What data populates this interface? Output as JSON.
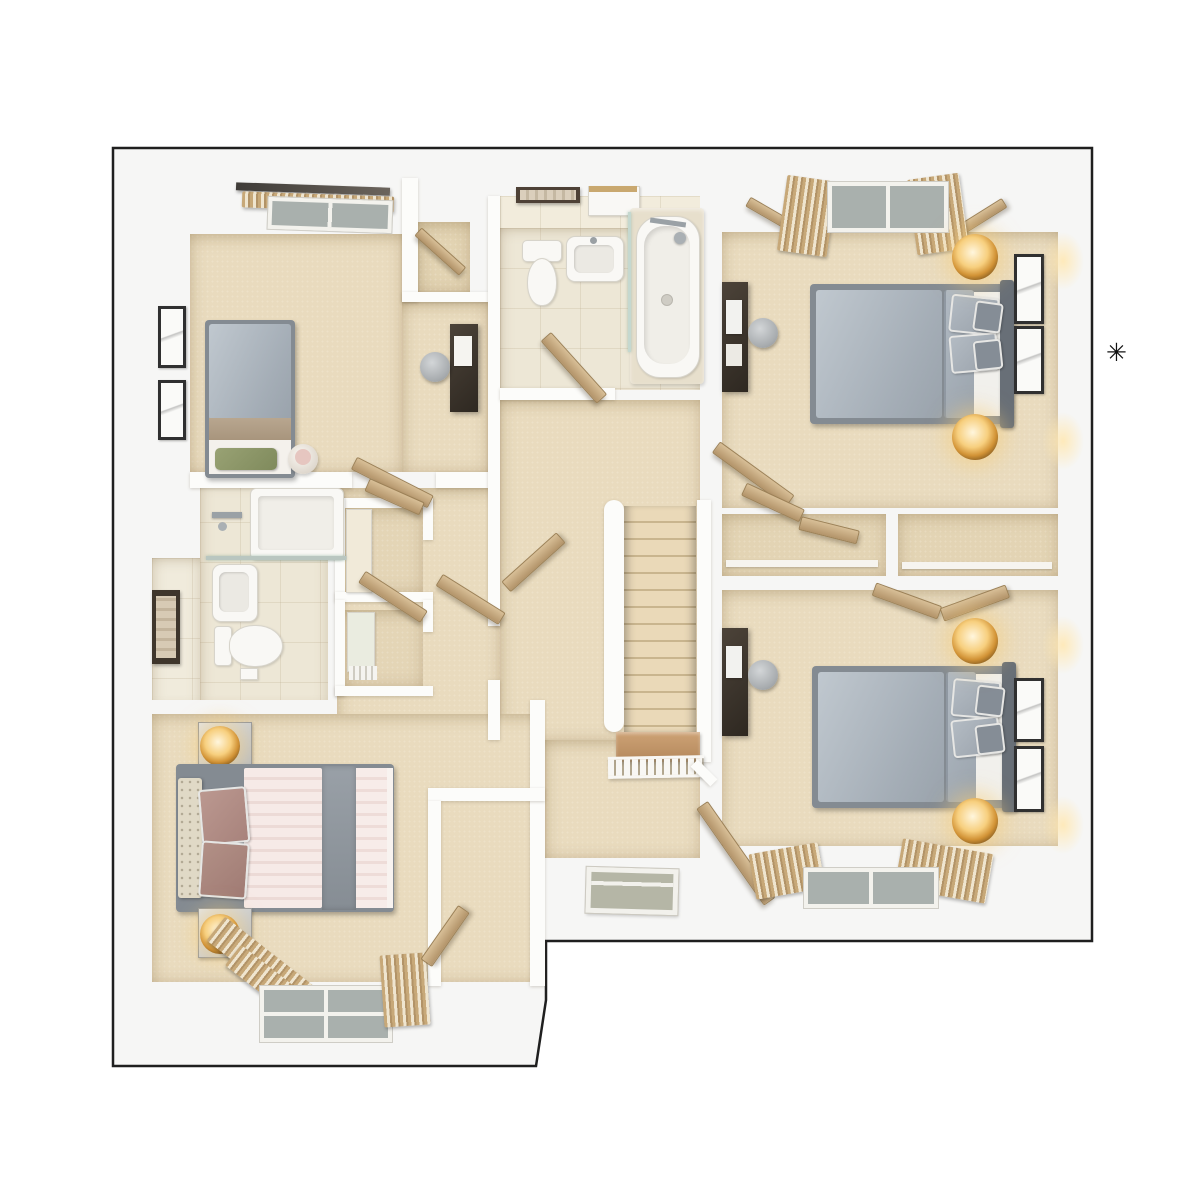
{
  "annotation": {
    "symbol": "✳"
  },
  "palette": {
    "outline": "#1f1f1f",
    "plate": "#f6f6f5",
    "wall": "#fcfcfa",
    "carpet": "#e9dbbe",
    "tile": "#ede7d6",
    "duvet_gray": "#aeb7c0",
    "duvet_pink": "#f4e7e3",
    "wood_door": "#c9ac80",
    "dark_furniture": "#3c352d",
    "lamp_glow": "#f5c469",
    "green_pillow": "#8d9668",
    "glass": "#b7bdb4"
  },
  "scene": {
    "type": "3d-floor-plan-render",
    "view": "top-down",
    "rooms": [
      {
        "name": "bedroom-top-left",
        "items": [
          "single-bed",
          "green-pillow",
          "picture-frames",
          "window-curtains",
          "desk",
          "chair",
          "pouf",
          "closet-nook"
        ]
      },
      {
        "name": "bathroom",
        "items": [
          "toilet",
          "basin",
          "bathtub",
          "shower-fixture",
          "glass-screen",
          "towel-shelf",
          "cabinet"
        ]
      },
      {
        "name": "bedroom-top-right",
        "items": [
          "double-bed",
          "bedside-lamps",
          "picture-frames",
          "desk",
          "chair",
          "window-curtains",
          "door"
        ]
      },
      {
        "name": "en-suite",
        "items": [
          "shower",
          "basin",
          "toilet",
          "towel-rail",
          "glass-screen"
        ]
      },
      {
        "name": "landing",
        "items": [
          "staircase",
          "banister",
          "spindle-rail",
          "open-doors",
          "storage-cupboards",
          "floor-window"
        ]
      },
      {
        "name": "bedroom-bottom-right",
        "items": [
          "double-bed",
          "bedside-lamps",
          "picture-frames",
          "desk",
          "chair",
          "window-curtains",
          "wardrobe-doors",
          "door"
        ]
      },
      {
        "name": "bedroom-bottom-left",
        "items": [
          "double-bed",
          "headboard",
          "bedside-cabinets",
          "lamps",
          "window-curtains",
          "wardrobe-nook"
        ]
      }
    ]
  }
}
